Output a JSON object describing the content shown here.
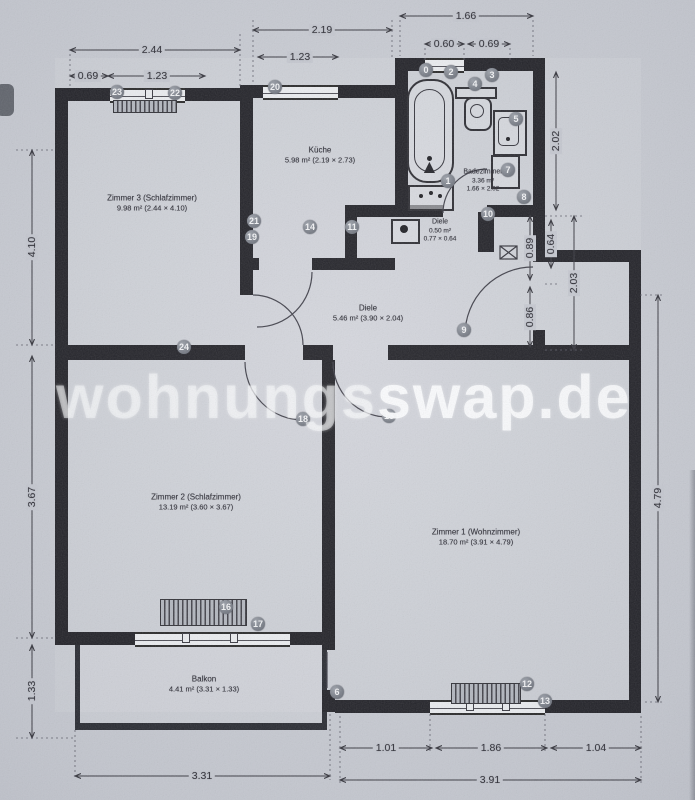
{
  "watermark": {
    "light_part": "wohnungs",
    "bold_part": "swap.de"
  },
  "rooms": {
    "zimmer3": {
      "name": "Zimmer 3 (Schlafzimmer)",
      "area": "9.98 m² (2.44 × 4.10)"
    },
    "kueche": {
      "name": "Küche",
      "area": "5.98 m² (2.19 × 2.73)"
    },
    "badezimmer": {
      "name": "Badezimmer",
      "area": "3.36 m²",
      "dims": "1.66 × 2.02"
    },
    "diele_klein": {
      "name": "Diele",
      "area": "0.50 m²",
      "dims": "0.77 × 0.64"
    },
    "diele": {
      "name": "Diele",
      "area": "5.46 m² (3.90 × 2.04)"
    },
    "zimmer2": {
      "name": "Zimmer 2 (Schlafzimmer)",
      "area": "13.19 m² (3.60 × 3.67)"
    },
    "zimmer1": {
      "name": "Zimmer 1 (Wohnzimmer)",
      "area": "18.70 m² (3.91 × 4.79)"
    },
    "balkon": {
      "name": "Balkon",
      "area": "4.41 m² (3.31 × 1.33)"
    }
  },
  "dimensions": {
    "top": {
      "zimmer3_total": "2.44",
      "kueche_total": "2.19",
      "bad_total": "1.66",
      "z3_left": "0.69",
      "z3_window": "1.23",
      "kueche_window": "1.23",
      "bad_window": "0.60",
      "bad_right": "0.69"
    },
    "left": {
      "zimmer3": "4.10",
      "zimmer2": "3.67",
      "balkon": "1.33"
    },
    "right": {
      "bad": "2.02",
      "niche_upper": "0.89",
      "niche_inner": "0.64",
      "entry": "0.86",
      "diele": "2.03",
      "zimmer1": "4.79"
    },
    "bottom": {
      "z1_left": "1.01",
      "z1_window": "1.86",
      "z1_right": "1.04",
      "balkon": "3.31",
      "zimmer1": "3.91"
    }
  },
  "markers": [
    "23",
    "22",
    "20",
    "0",
    "2",
    "4",
    "3",
    "5",
    "7",
    "1",
    "8",
    "10",
    "11",
    "14",
    "21",
    "19",
    "24",
    "9",
    "18",
    "15",
    "16",
    "17",
    "6",
    "12",
    "13"
  ]
}
